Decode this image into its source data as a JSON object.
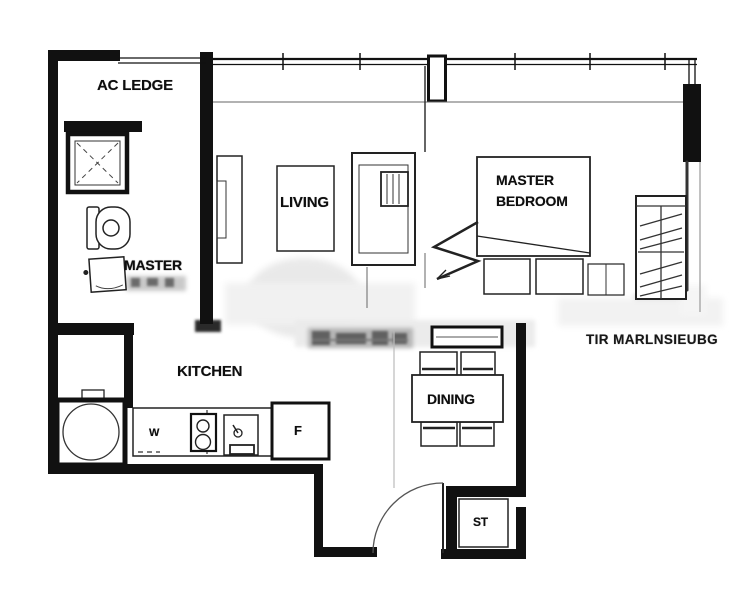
{
  "floorplan": {
    "project_name": "TIR MARLNSIEUBG",
    "rooms": {
      "ac_ledge": "AC LEDGE",
      "living": "LIVING",
      "master_bedroom": "MASTER\nBEDROOM",
      "master_bath": "MASTER",
      "kitchen": "KITCHEN",
      "dining": "DINING",
      "store": "ST"
    },
    "appliances": {
      "washer": "W",
      "fridge": "F"
    },
    "colors": {
      "wall": "#111111",
      "line": "#2a2a2a",
      "faint_smudge": "#c8c8c8",
      "background": "#ffffff"
    }
  }
}
